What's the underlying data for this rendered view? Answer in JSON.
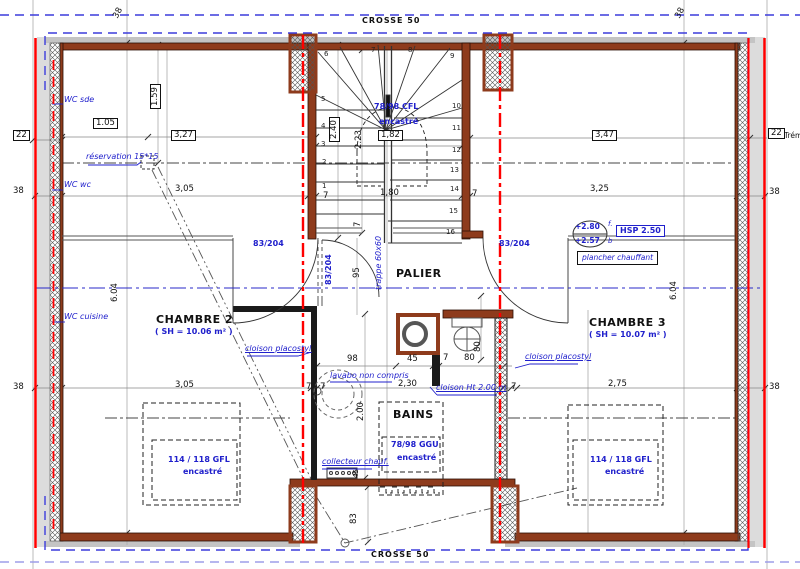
{
  "colors": {
    "wall": "#8e3b1c",
    "red_axis": "#ff0000",
    "blue_annotation": "#2020cc",
    "blue_boundary": "#3c3cdc",
    "construction_line": "#999999",
    "eave_gray": "#d9d9d9"
  },
  "titles": {
    "crosse_top": "CROSSE 50",
    "crosse_bottom": "CROSSE 50"
  },
  "rooms": {
    "chambre2": {
      "name": "CHAMBRE 2",
      "area": "( SH = 10.06 m² )"
    },
    "chambre3": {
      "name": "CHAMBRE 3",
      "area": "( SH = 10.07 m² )"
    },
    "palier": {
      "name": "PALIER"
    },
    "bains": {
      "name": "BAINS"
    }
  },
  "duct_labels": {
    "wc_sde": "WC sde",
    "wc_wc": "WC wc",
    "wc_cuisine": "WC cuisine"
  },
  "annotations": {
    "reservation": "réservation 15*15",
    "cloison_placostyl": "cloison placostyl",
    "cloison_ht": "cloison Ht 2.00 m",
    "lavabo": "lavabo non compris",
    "collecteur": "collecteur chauf.",
    "trappe": "trappe 60x60",
    "plancher_chauffant": "plancher chauffant",
    "hsp": "HSP 2.50",
    "tremie": "Trém"
  },
  "levels": {
    "upper": "+2.80",
    "upper_suffix": "f.",
    "lower": "+2.57",
    "lower_suffix": "b"
  },
  "windows": {
    "cfl": {
      "l1": "78/98 CFL",
      "l2": "encastré"
    },
    "ggu": {
      "l1": "78/98 GGU",
      "l2": "encastré"
    },
    "gfl": {
      "l1": "114 / 118 GFL",
      "l2": "encastré"
    }
  },
  "doors": {
    "label": "83/204"
  },
  "dims": {
    "d22": "22",
    "d38": "38",
    "d105": "1.05",
    "d327": "3,27",
    "d159": "1.59",
    "d240": "2.40",
    "d223": "2.23",
    "d182": "1,82",
    "d347": "3,47",
    "d305": "3,05",
    "d180": "1,80",
    "d325": "3,25",
    "d604": "6.04",
    "d95": "95",
    "d98": "98",
    "d45": "45",
    "d7": "7",
    "d80": "80",
    "d230": "2,30",
    "d200": "2.00",
    "d275": "2,75",
    "d83": "83"
  },
  "stairs": {
    "steps": [
      "1",
      "2",
      "3",
      "4",
      "5",
      "6",
      "7",
      "8",
      "9",
      "10",
      "11",
      "12",
      "13",
      "14",
      "15",
      "16"
    ]
  }
}
